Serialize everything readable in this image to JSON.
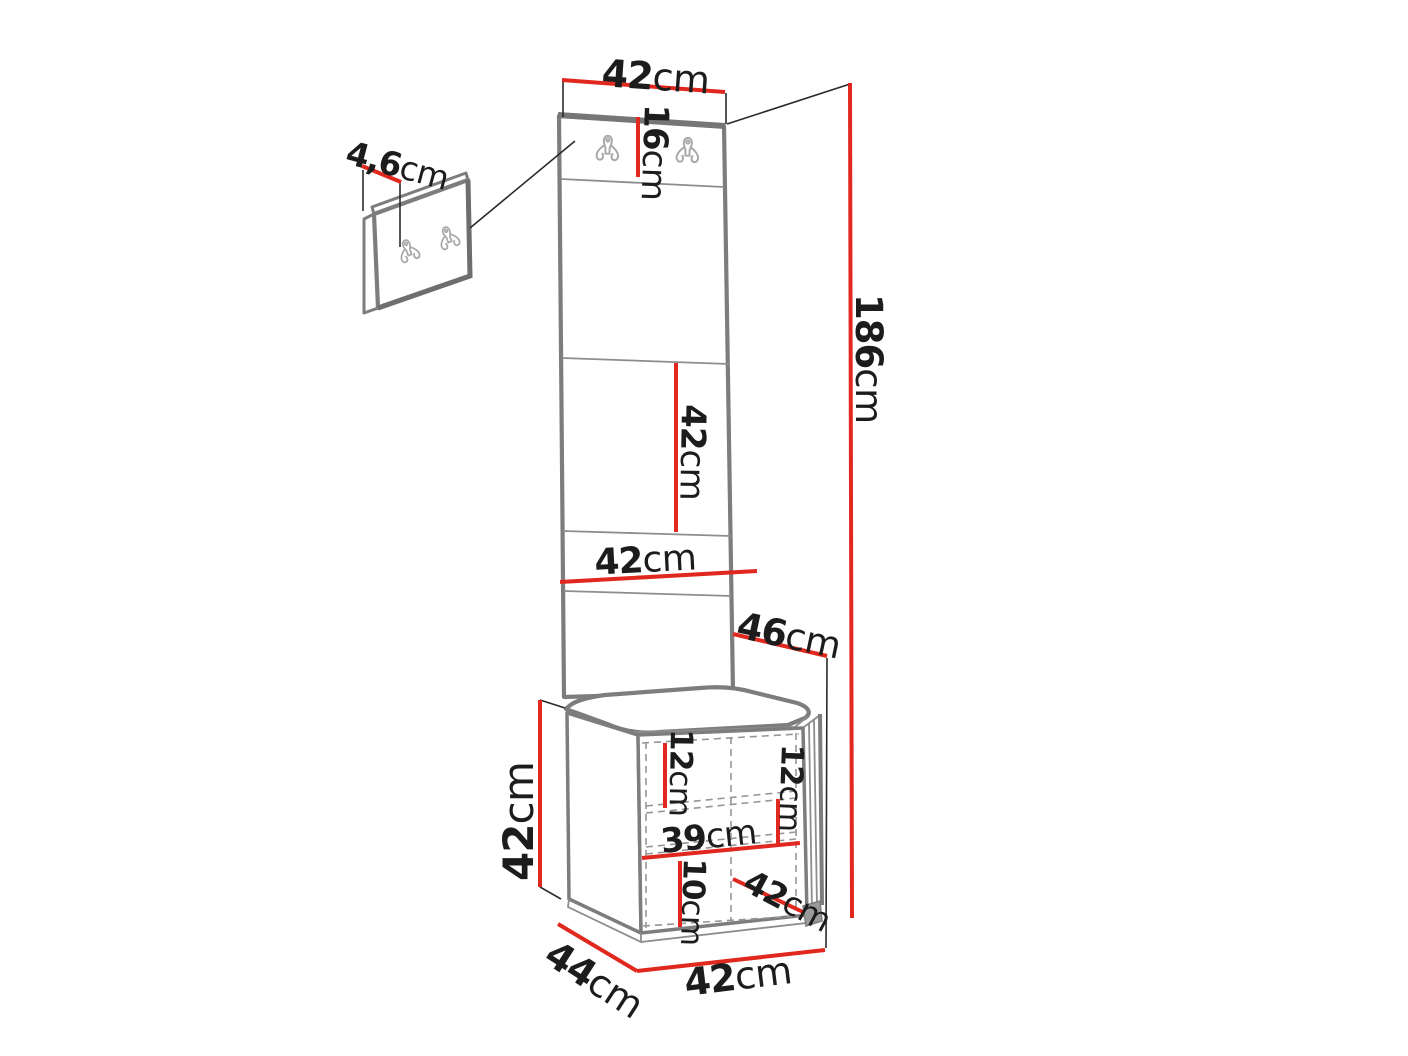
{
  "diagram": {
    "kind": "furniture dimension drawing",
    "subject": "hallway set: wall-mounted double-hook panel, upholstered panel column and bench cabinet with open shelf"
  },
  "colors": {
    "background": "#ffffff",
    "dimension_red": "#e0281e",
    "outline_gray": "#7d7d7d",
    "text_black": "#1c1c1c",
    "hook_gray": "#a8a8a8"
  },
  "labels": {
    "top_width": {
      "value": "42",
      "unit": "cm"
    },
    "hook_panel_height": {
      "value": "16",
      "unit": "cm"
    },
    "hook_offset": {
      "value": "4,6",
      "unit": "cm"
    },
    "total_height": {
      "value": "186",
      "unit": "cm"
    },
    "middle_panel_height": {
      "value": "42",
      "unit": "cm"
    },
    "panel_width": {
      "value": "42",
      "unit": "cm"
    },
    "seat_depth": {
      "value": "46",
      "unit": "cm"
    },
    "bench_height": {
      "value": "42",
      "unit": "cm"
    },
    "inner_top_height": {
      "value": "12",
      "unit": "cm"
    },
    "inner_right_height": {
      "value": "12",
      "unit": "cm"
    },
    "inner_width": {
      "value": "39",
      "unit": "cm"
    },
    "inner_bottom_height": {
      "value": "10",
      "unit": "cm"
    },
    "door_width": {
      "value": "42",
      "unit": "cm"
    },
    "bench_depth": {
      "value": "44",
      "unit": "cm"
    },
    "bench_width": {
      "value": "42",
      "unit": "cm"
    }
  }
}
